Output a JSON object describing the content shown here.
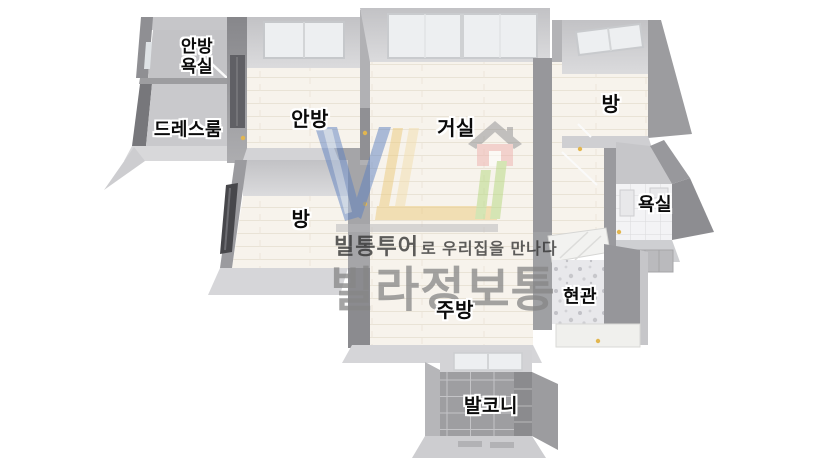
{
  "page": {
    "background_color": "#ffffff",
    "description": "3D isometric apartment floor plan with watermark"
  },
  "watermark": {
    "tagline_brand": "빌통투어",
    "tagline_rest": "로 우리집을 만나다",
    "brand_name": "빌라정보통",
    "logo_colors": {
      "blue": "#5d80c1",
      "blue_light": "#a9bede",
      "yellow": "#ecca7c",
      "yellow_light": "#f3dfae",
      "house_body": "#eeb0ae",
      "house_roof": "#8d8d90",
      "green": "#b4d87e",
      "underline": "#b7b7ba"
    },
    "text_colors": {
      "tagline": "#343434",
      "brand": "#868686"
    }
  },
  "floor_plan": {
    "wall_color": "#a8a8ab",
    "floor_wood_color": "#f7f3ec",
    "floor_gray_color": "#c9c9cc",
    "balcony_tile_color": "#9e9ea1",
    "rooms": [
      {
        "name": "master-bathroom",
        "label": "안방\n욕실"
      },
      {
        "name": "dress-room",
        "label": "드레스룸"
      },
      {
        "name": "master-bedroom",
        "label": "안방"
      },
      {
        "name": "living-room",
        "label": "거실"
      },
      {
        "name": "bedroom-right",
        "label": "방"
      },
      {
        "name": "bathroom",
        "label": "욕실"
      },
      {
        "name": "bedroom-left",
        "label": "방"
      },
      {
        "name": "kitchen",
        "label": "주방"
      },
      {
        "name": "entrance",
        "label": "현관"
      },
      {
        "name": "balcony",
        "label": "발코니"
      }
    ]
  }
}
